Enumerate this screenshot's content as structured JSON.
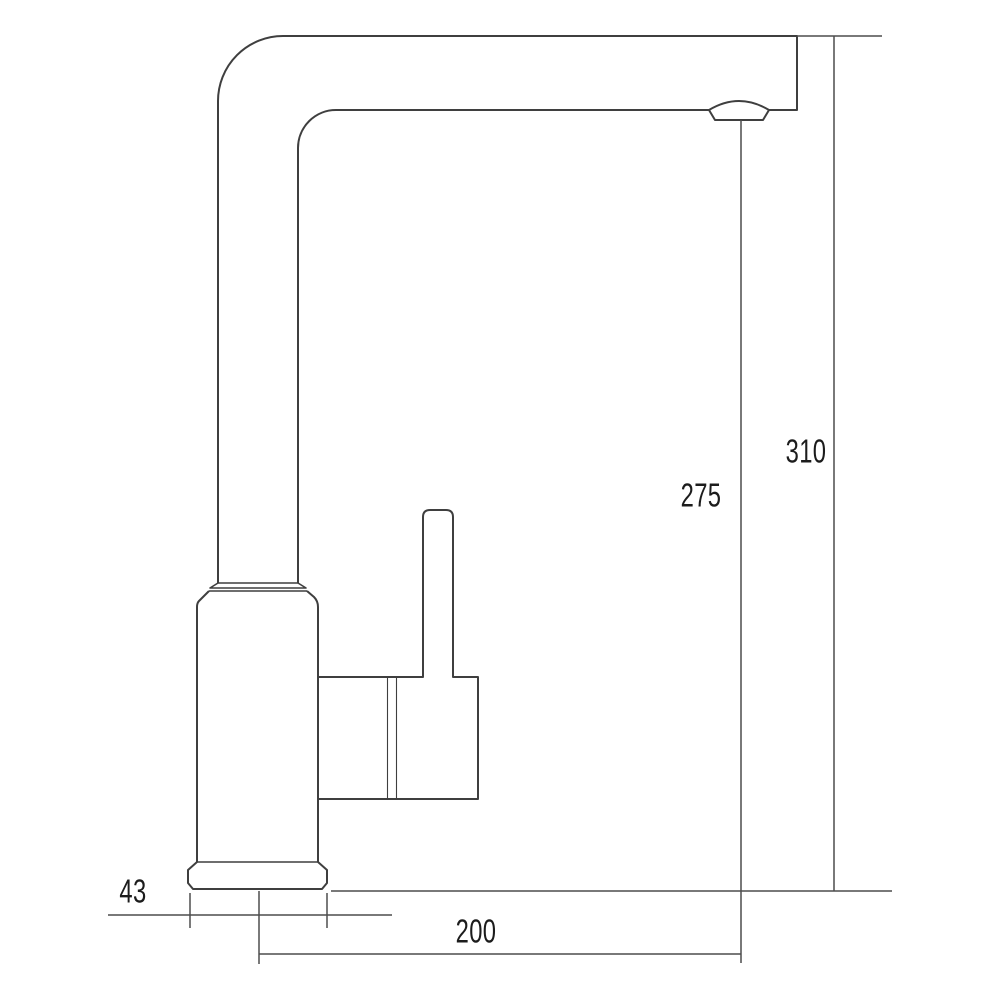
{
  "drawing": {
    "kind": "faucet-side-profile-dimension-drawing",
    "dimensions": {
      "base_width": "43",
      "spout_reach": "200",
      "spout_height_to_aerator": "275",
      "overall_height": "310"
    },
    "colors": {
      "background": "#ffffff",
      "line": "#3f3f3f",
      "dimension_line": "#4d4d4d",
      "text": "#1c1c1c"
    }
  }
}
